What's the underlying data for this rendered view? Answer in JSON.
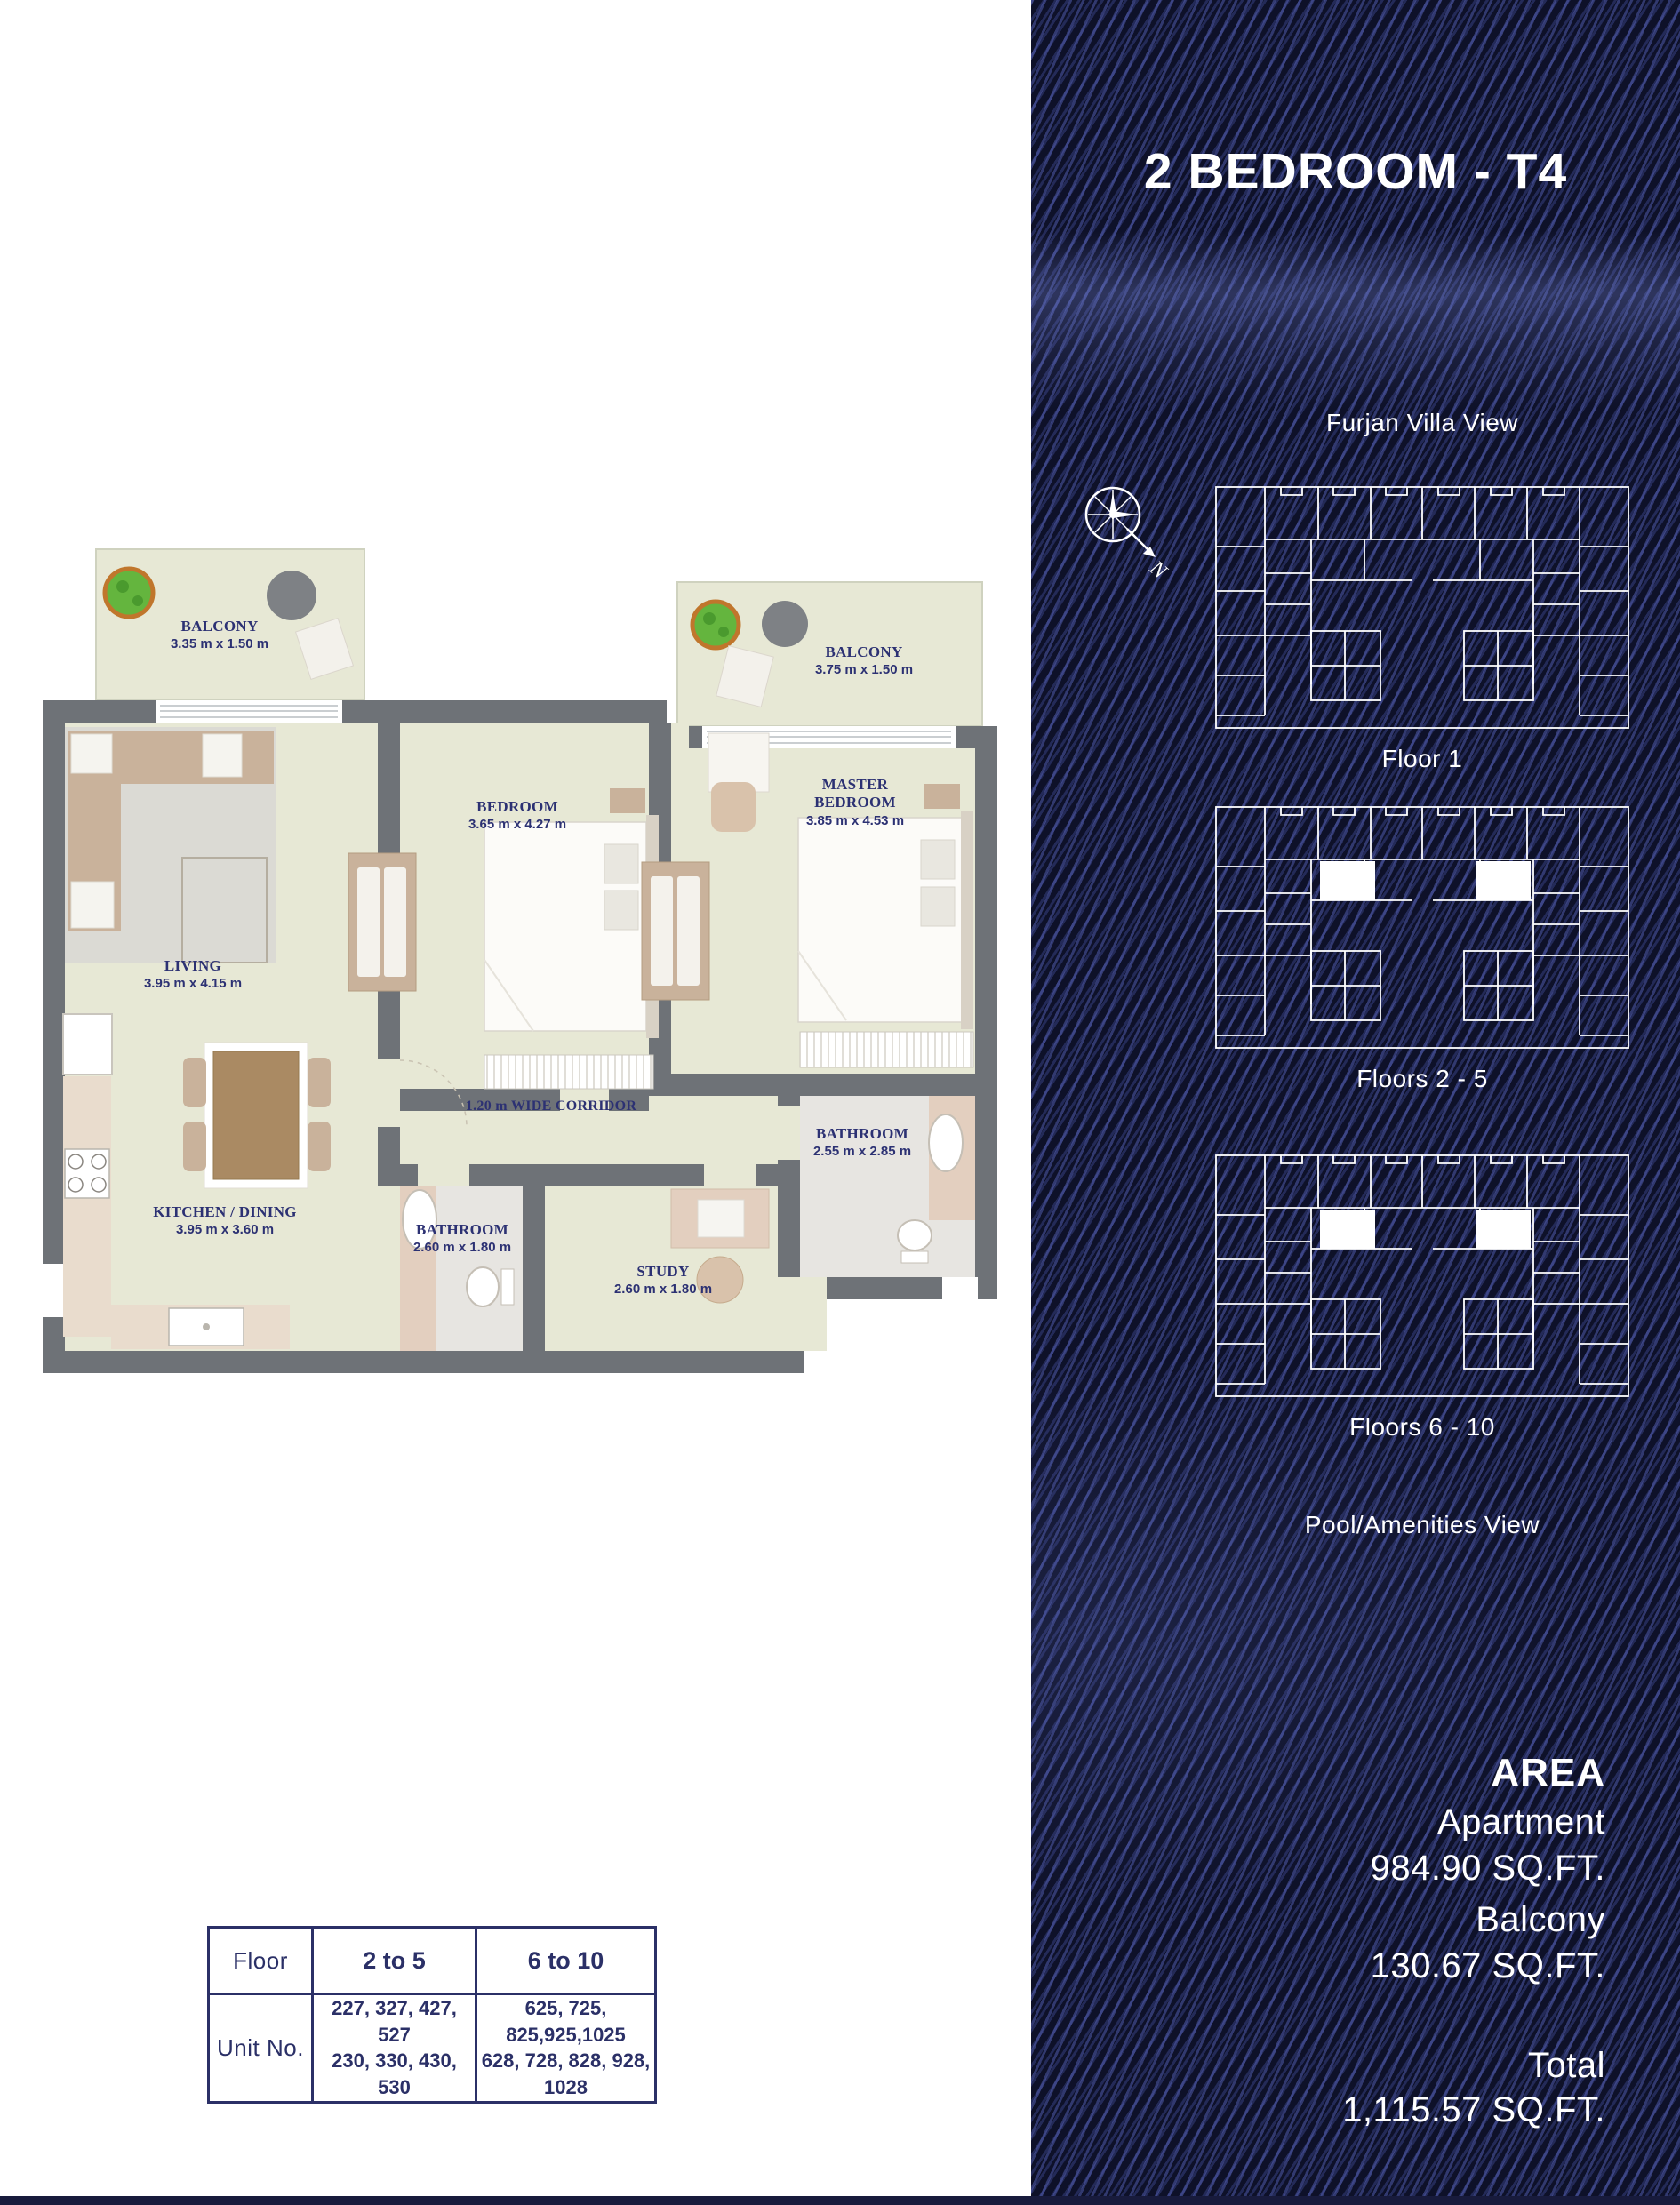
{
  "sidebar": {
    "title": "2 BEDROOM - T4",
    "top_view_label": "Furjan Villa View",
    "bottom_view_label": "Pool/Amenities View",
    "compass_label": "N",
    "floor_maps": [
      {
        "label": "Floor 1",
        "highlighted": false
      },
      {
        "label": "Floors 2 - 5",
        "highlighted": true
      },
      {
        "label": "Floors 6 - 10",
        "highlighted": true
      }
    ],
    "area": {
      "heading": "AREA",
      "apartment_label": "Apartment",
      "apartment_value": "984.90 SQ.FT.",
      "balcony_label": "Balcony",
      "balcony_value": "130.67 SQ.FT.",
      "total_label": "Total",
      "total_value": "1,115.57 SQ.FT."
    },
    "colors": {
      "background": "#0e1129",
      "stripe": "#5460b4",
      "text": "#ffffff"
    }
  },
  "floor_plan": {
    "labels": {
      "balcony_left": {
        "name": "BALCONY",
        "dims": "3.35 m x 1.50 m"
      },
      "balcony_right": {
        "name": "BALCONY",
        "dims": "3.75 m x 1.50 m"
      },
      "living": {
        "name": "LIVING",
        "dims": "3.95 m x 4.15 m"
      },
      "bedroom": {
        "name": "BEDROOM",
        "dims": "3.65 m x 4.27 m"
      },
      "master_bedroom": {
        "name": "MASTER BEDROOM",
        "dims": "3.85 m x 4.53 m"
      },
      "kitchen": {
        "name": "KITCHEN / DINING",
        "dims": "3.95 m x 3.60 m"
      },
      "bathroom_small": {
        "name": "BATHROOM",
        "dims": "2.60 m x 1.80 m"
      },
      "study": {
        "name": "STUDY",
        "dims": "2.60 m x 1.80 m"
      },
      "bathroom_master": {
        "name": "BATHROOM",
        "dims": "2.55 m x 2.85 m"
      },
      "corridor": {
        "name": "1.20 m WIDE CORRIDOR"
      }
    },
    "colors": {
      "wall": "#6e7277",
      "room": "#e7e8d5",
      "label_text": "#2c3173"
    }
  },
  "units_table": {
    "row1": {
      "header": "Floor",
      "col1": "2 to 5",
      "col2": "6 to 10"
    },
    "row2": {
      "header": "Unit No.",
      "col1_line1": "227, 327, 427, 527",
      "col1_line2": "230, 330, 430, 530",
      "col2_line1": "625, 725, 825,925,1025",
      "col2_line2": "628, 728, 828, 928, 1028"
    }
  }
}
